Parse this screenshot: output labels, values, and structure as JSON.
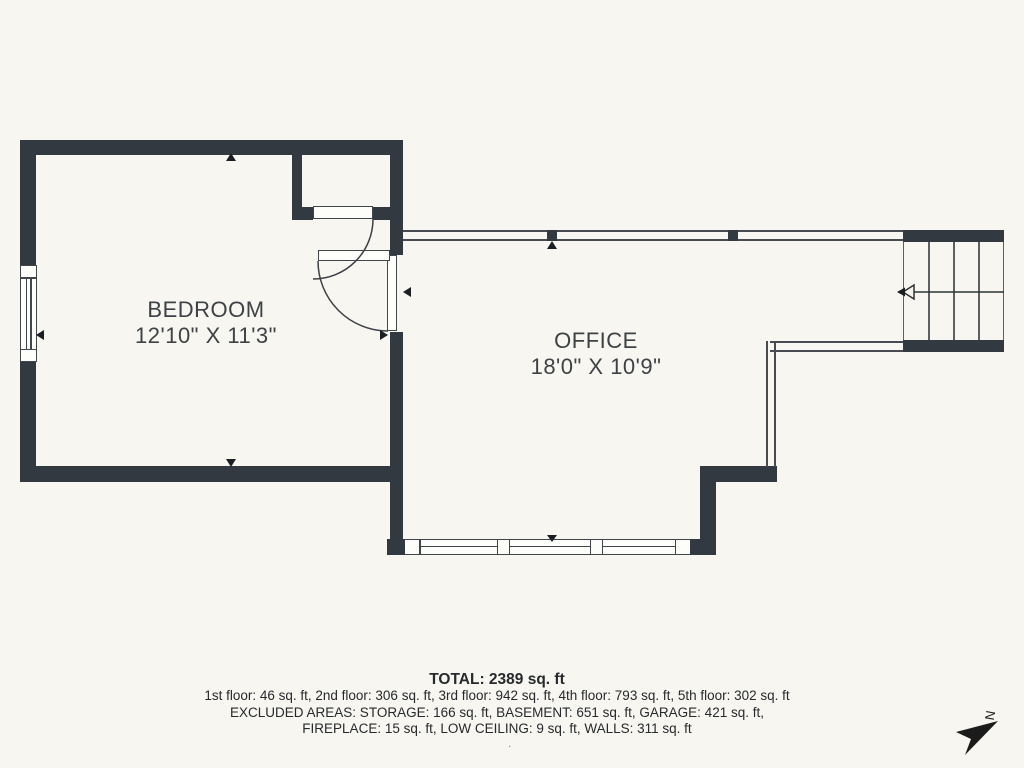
{
  "floor_plan": {
    "rooms": [
      {
        "name": "BEDROOM",
        "dimensions": "12'10\" X 11'3\""
      },
      {
        "name": "OFFICE",
        "dimensions": "18'0\" X 10'9\""
      }
    ],
    "summary": {
      "total": "TOTAL: 2389 sq. ft",
      "floors": "1st floor: 46 sq. ft, 2nd floor: 306 sq. ft, 3rd floor: 942 sq. ft, 4th floor: 793 sq. ft, 5th floor: 302 sq. ft",
      "excluded_line1": "EXCLUDED AREAS: STORAGE: 166 sq. ft, BASEMENT: 651 sq. ft, GARAGE: 421 sq. ft,",
      "excluded_line2": "FIREPLACE: 15 sq. ft, LOW CEILING: 9 sq. ft, WALLS: 311 sq. ft",
      "footnote_dot": "."
    },
    "compass": {
      "label": "N"
    },
    "colors": {
      "background": "#f7f6f0",
      "wall": "#333940",
      "thin_line": "#474b51",
      "frame": "#41464d",
      "text": "#3e4247",
      "summary_text": "#26292d",
      "marker": "#1b1e22",
      "compass": "#1b1b1b",
      "stair_tread": "#5c6064"
    }
  }
}
